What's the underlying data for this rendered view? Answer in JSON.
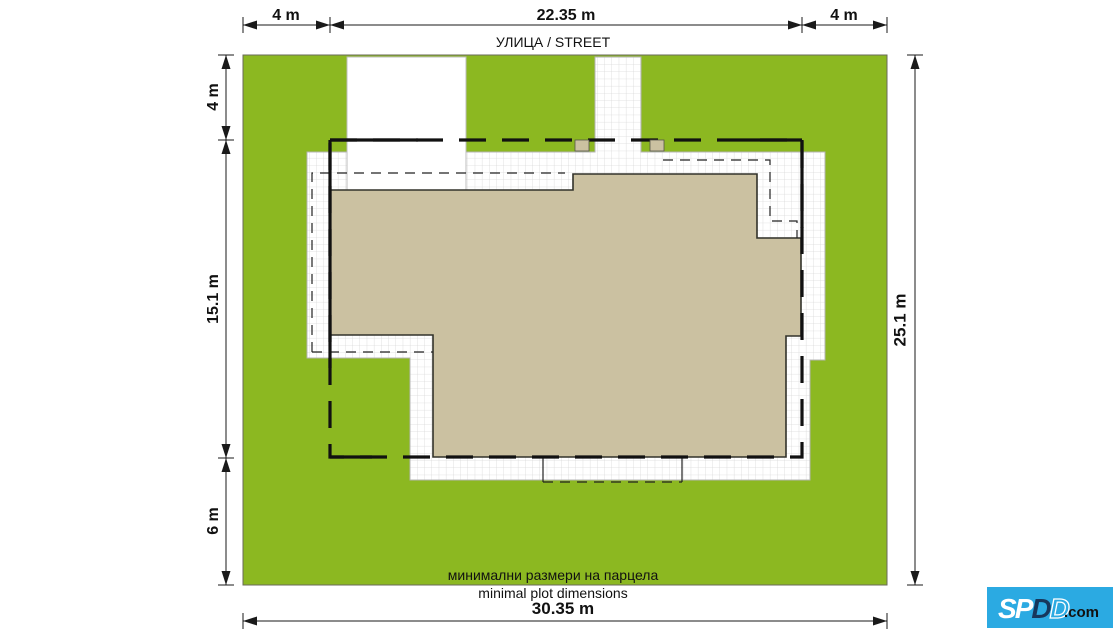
{
  "plan": {
    "street_label": "УЛИЦА / STREET",
    "captions": {
      "bg": "минимални размери на парцела",
      "en": "minimal plot dimensions"
    },
    "dimensions": {
      "top": [
        "4 m",
        "22.35 m",
        "4 m"
      ],
      "left": [
        "4 m",
        "15.1 m",
        "6 m"
      ],
      "right": "25.1 m",
      "bottom": "30.35 m"
    },
    "colors": {
      "grass": "#8cb821",
      "building": "#cbc1a1",
      "paving_line": "#d9d9d9",
      "outline": "#1a1a1a",
      "logo_bg": "#2baae2",
      "logo_dark": "#17375c"
    }
  },
  "logo": {
    "text": "SPDD.com",
    "s": "S",
    "p": "P",
    "d1": "D",
    "d2": "D",
    "tld": ".com"
  }
}
